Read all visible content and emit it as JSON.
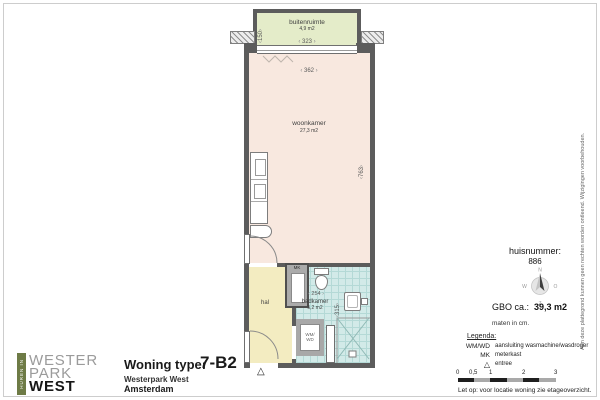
{
  "logo": {
    "vertical_label": "HUREN IN",
    "line1": "WESTER",
    "line2": "PARK",
    "line3": "WEST"
  },
  "title_block": {
    "label": "Woning type:",
    "type_code": "7-B2",
    "project": "Westerpark West",
    "city": "Amsterdam"
  },
  "info_panel": {
    "huisnummer_label": "huisnummer:",
    "huisnummer_value": "886",
    "compass": {
      "north": "N",
      "east": "O",
      "south": "Z",
      "west": "W"
    },
    "gbo_label": "GBO ca.:",
    "gbo_value": "39,3 m2",
    "units_note": "maten in cm.",
    "legend_title": "Legenda:",
    "legend": [
      {
        "key": "WM/WD",
        "desc": "aansluiting wasmachine/wasdroger"
      },
      {
        "key": "MK",
        "desc": "meterkast"
      },
      {
        "key": "△",
        "desc": "entree"
      }
    ],
    "scale_ticks": [
      "0",
      "0,5",
      "1",
      "2",
      "3"
    ],
    "note": "Let op:  voor locatie woning zie etageoverzicht."
  },
  "plan": {
    "buitenruimte_label": "buitenruimte",
    "buitenruimte_area": "4,9 m2",
    "woonkamer_label": "woonkamer",
    "woonkamer_area": "27,3 m2",
    "hal_label": "hal",
    "badkamer_label": "badkamer",
    "badkamer_area": "5,2 m2",
    "dim_buitenruimte_width": "323",
    "dim_buitenruimte_depth": "150",
    "dim_woonkamer_width": "362",
    "dim_woonkamer_depth": "763",
    "dim_badkamer_width": "254",
    "dim_badkamer_depth": "315",
    "wm_wd_line1": "WM/",
    "wm_wd_line2": "WD",
    "mk_label": "MK",
    "entree_symbol": "△"
  },
  "disclaimer": "Aan deze plattegrond kunnen geen rechten worden ontleend. Wijzigingen voorbehouden.",
  "colors": {
    "logo-green": "#6E7B46",
    "wall": "#5C5C5C",
    "woonkamer": "#F8E8DF",
    "hal": "#F3ECC1",
    "badkamer": "#D2EAE8",
    "badkamer-grid": "#B4D9D6",
    "buitenruimte": "#E4ECC9"
  }
}
